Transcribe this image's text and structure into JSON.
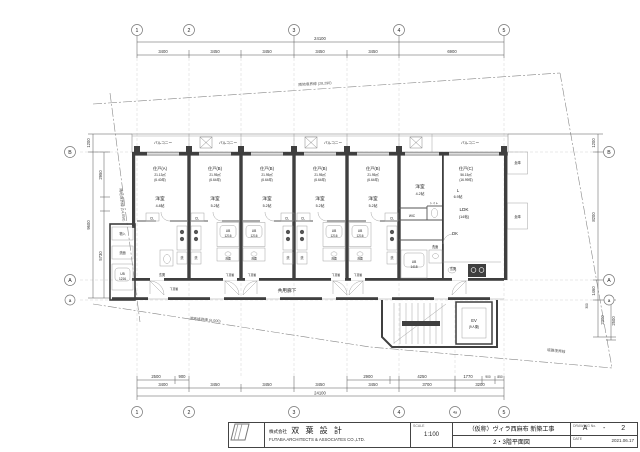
{
  "drawing": {
    "grid": {
      "top_bubbles": [
        "1",
        "2",
        "3",
        "4",
        "5"
      ],
      "bottom_bubbles": [
        "1",
        "2",
        "3",
        "4",
        "4a",
        "5"
      ],
      "left_bubbles": [
        "B",
        "A",
        "a"
      ],
      "right_bubbles": [
        "B",
        "A",
        "a"
      ]
    },
    "dims": {
      "top_total": "24100",
      "top_segments": [
        "3400",
        "3450",
        "3450",
        "3450",
        "3450",
        "6900"
      ],
      "bottom_row1": [
        "2500",
        "900",
        "2900",
        "4250",
        "1770",
        "900",
        "850"
      ],
      "bottom_row2": [
        "3400",
        "3450",
        "3450",
        "3450",
        "3450",
        "3700",
        "3200"
      ],
      "bottom_total": "24100",
      "left": [
        "1200",
        "2950",
        "9600",
        "5730"
      ],
      "right": [
        "1200",
        "8200",
        "1460",
        "300",
        "2300",
        "2500"
      ]
    },
    "boundary_labels": {
      "top": "隣地境界線 (28,290)",
      "left": "隣地境界線 (14,050)",
      "bottom": "道路境界線 (6,000)",
      "bottom_right": "道路境界線"
    },
    "units": {
      "a": {
        "name": "住戸(A)",
        "area": "21.13㎡",
        "tsubo": "(6.40坪)",
        "room": "洋室",
        "size": "4.8帖"
      },
      "b": {
        "name": "住戸(B)",
        "area": "21.95㎡",
        "tsubo": "(6.64坪)",
        "room": "洋室",
        "size": "5.2帖"
      },
      "c": {
        "name": "住戸(C)",
        "area": "56.15㎡",
        "tsubo": "(16.99坪)",
        "room": "洋室",
        "size": "4.2帖",
        "l": "L",
        "l_size": "6.9帖",
        "ldk": "LDK",
        "ldk_size": "(14帖)",
        "dk": "DK"
      }
    },
    "fixtures": {
      "cl": "CL",
      "washer": "洗",
      "basin": "洗面",
      "ub": "UB",
      "ub_small_size": "1216",
      "ub_large_size": "1418",
      "entrance": "玄関",
      "shoe": "下足箱",
      "storage": "物入",
      "wic": "WIC",
      "toilet": "トイレ",
      "warehouse": "倉庫",
      "balcony": "バルコニー",
      "corridor": "共用廊下",
      "elevator": "EV",
      "elevator_cap": "(9人乗)"
    }
  },
  "titleblock": {
    "company_jp_prefix": "株式会社",
    "company_jp": "双 葉 設 計",
    "company_en": "FUTABA ARCHITECTS & ASSOCIATES CO.,LTD.",
    "scale_label": "SCALE",
    "scale_value": "1:100",
    "project": "（仮称）ヴィラ西麻布 新築工事",
    "sheet_title": "2・3階平面図",
    "no_label": "DRAWING No.",
    "no_value": "A - 2",
    "date_label": "DATE",
    "date_value": "2021.06.17"
  }
}
